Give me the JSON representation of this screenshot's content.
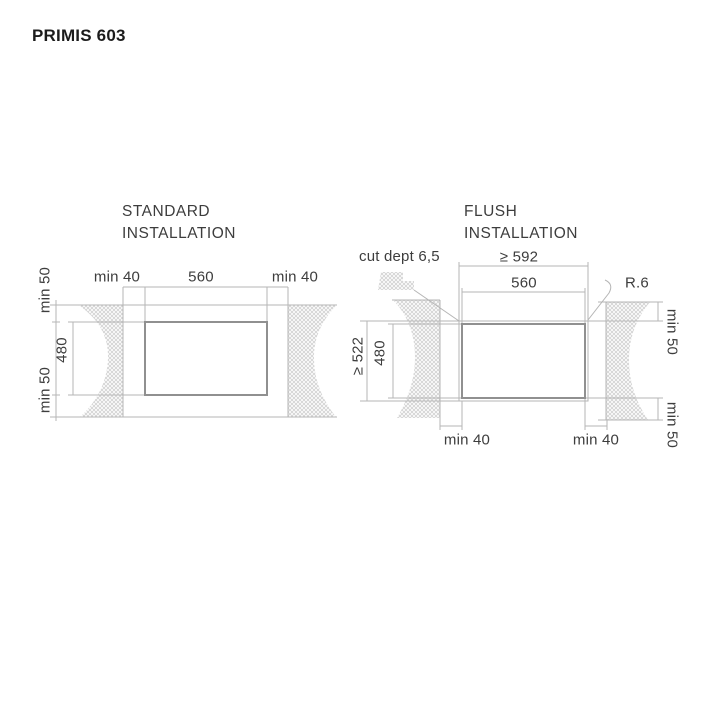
{
  "page": {
    "title": "PRIMIS 603"
  },
  "colors": {
    "line": "#b5b5b5",
    "cutout_line": "#909090",
    "hatch": "#d2d2d2",
    "text": "#3d3d3d",
    "title_text": "#1c1c1c",
    "background": "#ffffff"
  },
  "standard": {
    "title_line_1": "STANDARD",
    "title_line_2": "INSTALLATION",
    "dim_top_left_clearance": "min 40",
    "dim_top_width": "560",
    "dim_top_right_clearance": "min 40",
    "dim_left_top_clearance": "min 50",
    "dim_left_height": "480",
    "dim_left_bottom_clearance": "min 50"
  },
  "flush": {
    "title_line_1": "FLUSH",
    "title_line_2": "INSTALLATION",
    "dim_cut_depth": "cut dept 6,5",
    "dim_outer_width": "≥ 592",
    "dim_inner_width": "560",
    "dim_corner_radius": "R.6",
    "dim_outer_height": "≥ 522",
    "dim_inner_height": "480",
    "dim_right_top_clearance": "min 50",
    "dim_right_bottom_clearance": "min 50",
    "dim_bottom_left_clearance": "min 40",
    "dim_bottom_right_clearance": "min 40"
  }
}
